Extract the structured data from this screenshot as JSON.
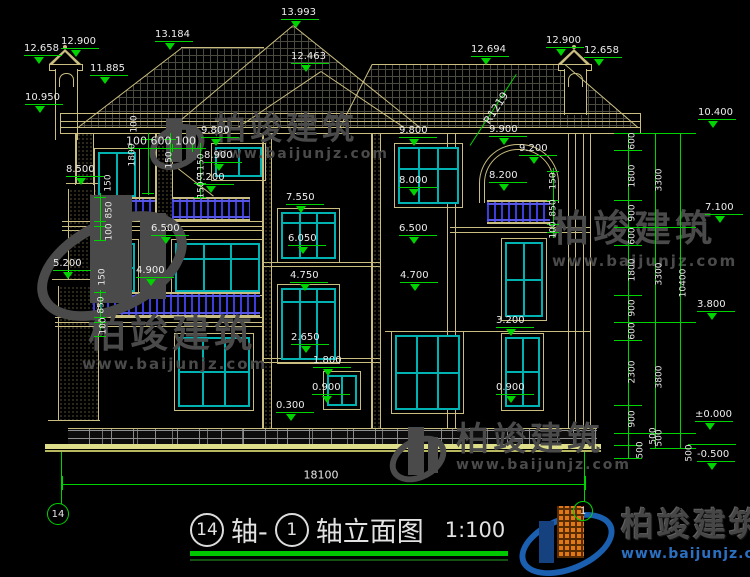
{
  "meta": {
    "drawing_type": "building elevation",
    "sheet_bg": "#000000"
  },
  "colors": {
    "line_tan": "#c9bd7f",
    "dim_green": "#00d400",
    "window_teal": "#00b2b2",
    "railing_blue": "#3c3cdc",
    "text_white": "#ededed",
    "ground_yellow": "#dede8a",
    "stone_gray": "#909090",
    "watermark_gray": "#4a4a4a",
    "logo_blue": "#1a5fb0",
    "logo_orange": "#e07818",
    "url_blue": "#2b6fc0",
    "title_underline_green": "#00c800"
  },
  "title_block": {
    "axis_a": "14",
    "join": "轴-",
    "axis_b": "1",
    "suffix": "轴立面图",
    "scale": "1:100"
  },
  "axis_bubbles": {
    "left": "14",
    "right": "1"
  },
  "brand": {
    "name": "柏竣建筑",
    "url": "www.baijunjz.com"
  },
  "watermarks": [
    {
      "text": "柏竣建筑",
      "url": "www.baijunjz.com"
    },
    {
      "text": "柏竣建筑",
      "url": "www.baijunjz.com"
    },
    {
      "text": "柏竣建筑",
      "url": "www.baijunjz.com"
    },
    {
      "text": "柏竣建筑",
      "url": "www.baijunjz.com"
    }
  ],
  "annotations": {
    "elevation_markers": [
      [
        "13.993",
        281,
        8
      ],
      [
        "13.184",
        155,
        30
      ],
      [
        "12.463",
        291,
        52
      ],
      [
        "12.900",
        61,
        37
      ],
      [
        "12.658",
        24,
        44
      ],
      [
        "11.885",
        90,
        64
      ],
      [
        "10.950",
        25,
        93
      ],
      [
        "12.694",
        471,
        45
      ],
      [
        "12.900",
        546,
        36
      ],
      [
        "12.658",
        584,
        46
      ],
      [
        "9.800",
        201,
        126
      ],
      [
        "9.800",
        399,
        126
      ],
      [
        "9.900",
        489,
        125
      ],
      [
        "9.200",
        519,
        144
      ],
      [
        "8.900",
        204,
        151
      ],
      [
        "8.200",
        196,
        173
      ],
      [
        "8.200",
        489,
        171
      ],
      [
        "8.000",
        399,
        176
      ],
      [
        "8.500",
        66,
        165
      ],
      [
        "7.550",
        286,
        193
      ],
      [
        "6.050",
        288,
        234
      ],
      [
        "6.500",
        151,
        224
      ],
      [
        "6.500",
        399,
        224
      ],
      [
        "5.200",
        53,
        259
      ],
      [
        "4.900",
        136,
        266
      ],
      [
        "4.750",
        290,
        271
      ],
      [
        "4.700",
        400,
        271
      ],
      [
        "3.200",
        496,
        316
      ],
      [
        "2.650",
        291,
        333
      ],
      [
        "1.800",
        313,
        356
      ],
      [
        "0.900",
        312,
        383
      ],
      [
        "0.900",
        496,
        383
      ],
      [
        "0.300",
        276,
        401
      ],
      [
        "10.400",
        698,
        108
      ],
      [
        "7.100",
        705,
        203
      ],
      [
        "3.800",
        697,
        300
      ],
      [
        "±0.000",
        695,
        410
      ],
      [
        "-0.500",
        697,
        450
      ]
    ],
    "rotated_dims": [
      [
        "150",
        109,
        183
      ],
      [
        "850",
        110,
        210
      ],
      [
        "100",
        110,
        232
      ],
      [
        "150",
        103,
        277
      ],
      [
        "850",
        102,
        305
      ],
      [
        "100",
        104,
        326
      ],
      [
        "100",
        135,
        124
      ],
      [
        "1800",
        133,
        155
      ],
      [
        "150",
        170,
        160
      ],
      [
        "1150",
        202,
        165
      ],
      [
        "150",
        202,
        190
      ],
      [
        "150",
        554,
        181
      ],
      [
        "850",
        554,
        208
      ],
      [
        "100",
        554,
        230
      ],
      [
        "600",
        633,
        141
      ],
      [
        "1800",
        633,
        176
      ],
      [
        "900",
        633,
        213
      ],
      [
        "600",
        633,
        236
      ],
      [
        "1800",
        633,
        270
      ],
      [
        "900",
        633,
        308
      ],
      [
        "600",
        633,
        331
      ],
      [
        "2300",
        633,
        372
      ],
      [
        "900",
        633,
        419
      ],
      [
        "500",
        641,
        450
      ],
      [
        "500",
        654,
        436
      ],
      [
        "3300",
        660,
        180
      ],
      [
        "3300",
        660,
        274
      ],
      [
        "3800",
        660,
        377
      ],
      [
        "500",
        660,
        438
      ],
      [
        "10400",
        684,
        283
      ],
      [
        "500",
        690,
        453
      ]
    ],
    "inline_dims": [
      [
        "100 600 100",
        161,
        141,
        0
      ],
      [
        "18100",
        321,
        475,
        0
      ],
      [
        "R1219",
        496,
        108,
        -57
      ]
    ]
  },
  "windows": [
    [
      215,
      147,
      47,
      30,
      2,
      0
    ],
    [
      98,
      152,
      38,
      45,
      2,
      0
    ],
    [
      398,
      147,
      61,
      57,
      3,
      0.37
    ],
    [
      98,
      243,
      37,
      49,
      2,
      0.5
    ],
    [
      175,
      243,
      85,
      49,
      3,
      0.32
    ],
    [
      281,
      212,
      55,
      47,
      3,
      0.22
    ],
    [
      281,
      288,
      55,
      72,
      3,
      0.17
    ],
    [
      327,
      375,
      30,
      31,
      2,
      0
    ],
    [
      505,
      242,
      38,
      75,
      2,
      0.5
    ],
    [
      395,
      335,
      65,
      75,
      3,
      0.5
    ],
    [
      505,
      337,
      35,
      70,
      2,
      0.5
    ],
    [
      178,
      337,
      72,
      70,
      3,
      0.5
    ]
  ],
  "railings": [
    [
      93,
      197,
      62,
      24
    ],
    [
      172,
      197,
      78,
      24
    ],
    [
      93,
      292,
      167,
      25
    ],
    [
      487,
      200,
      63,
      24
    ]
  ],
  "geometry": {
    "tan_h": [
      [
        60,
        113,
        580
      ],
      [
        60,
        121,
        580
      ],
      [
        60,
        127,
        580
      ],
      [
        60,
        133,
        580
      ],
      [
        62,
        221,
        200
      ],
      [
        62,
        226,
        200
      ],
      [
        62,
        230,
        200
      ],
      [
        55,
        317,
        207
      ],
      [
        55,
        322,
        207
      ],
      [
        55,
        326,
        207
      ],
      [
        450,
        227,
        140
      ],
      [
        450,
        232,
        140
      ],
      [
        262,
        262,
        118
      ],
      [
        262,
        266,
        118
      ],
      [
        262,
        358,
        118
      ],
      [
        262,
        362,
        118
      ],
      [
        385,
        331,
        205
      ],
      [
        66,
        183,
        34
      ],
      [
        52,
        279,
        48
      ],
      [
        48,
        420,
        52
      ],
      [
        181,
        47,
        83
      ],
      [
        372,
        64,
        193
      ]
    ],
    "tan_v": [
      [
        75,
        133,
        52
      ],
      [
        93,
        133,
        52
      ],
      [
        262,
        133,
        295
      ],
      [
        271,
        133,
        295
      ],
      [
        371,
        133,
        295
      ],
      [
        380,
        133,
        295
      ],
      [
        447,
        133,
        295
      ],
      [
        455,
        133,
        295
      ],
      [
        568,
        133,
        295
      ],
      [
        575,
        133,
        295
      ],
      [
        583,
        133,
        295
      ],
      [
        590,
        133,
        295
      ],
      [
        60,
        113,
        20
      ],
      [
        640,
        113,
        20
      ],
      [
        155,
        133,
        95
      ],
      [
        172,
        133,
        95
      ]
    ],
    "speckle": [
      [
        76,
        133,
        16,
        50
      ],
      [
        68,
        189,
        29,
        90
      ],
      [
        58,
        286,
        39,
        134
      ],
      [
        156,
        133,
        15,
        92
      ],
      [
        263,
        133,
        7,
        295
      ],
      [
        372,
        133,
        7,
        295
      ]
    ],
    "slopes": [
      [
        172,
        127,
        158,
        -40.1
      ],
      [
        293,
        25,
        163,
        38.8
      ],
      [
        238,
        127,
        100,
        -34
      ],
      [
        321,
        71,
        100,
        34
      ],
      [
        78,
        127,
        130,
        -37.5
      ],
      [
        340,
        127,
        71,
        -63
      ],
      [
        565,
        64,
        97,
        40.8
      ]
    ],
    "green_slopes": [
      [
        470,
        145,
        85,
        -57
      ]
    ],
    "green_v": [
      [
        628,
        133,
        325
      ],
      [
        655,
        133,
        315
      ],
      [
        680,
        133,
        315
      ],
      [
        61,
        452,
        52
      ],
      [
        584,
        452,
        50
      ],
      [
        100,
        193,
        47
      ],
      [
        100,
        290,
        40
      ],
      [
        148,
        133,
        62
      ],
      [
        170,
        133,
        28
      ],
      [
        200,
        143,
        56
      ],
      [
        553,
        168,
        70
      ],
      [
        62,
        476,
        14
      ],
      [
        585,
        476,
        14
      ],
      [
        131,
        144,
        8
      ],
      [
        148,
        144,
        8
      ],
      [
        172,
        144,
        8
      ],
      [
        192,
        144,
        8
      ]
    ],
    "green_h": [
      [
        614,
        133,
        28
      ],
      [
        614,
        150,
        28
      ],
      [
        614,
        200,
        28
      ],
      [
        614,
        227,
        28
      ],
      [
        614,
        245,
        28
      ],
      [
        614,
        295,
        28
      ],
      [
        614,
        322,
        28
      ],
      [
        614,
        340,
        28
      ],
      [
        614,
        405,
        28
      ],
      [
        614,
        433,
        28
      ],
      [
        614,
        445,
        28
      ],
      [
        614,
        458,
        28
      ],
      [
        614,
        133,
        82
      ],
      [
        614,
        227,
        82
      ],
      [
        614,
        322,
        82
      ],
      [
        614,
        433,
        82
      ],
      [
        650,
        448,
        46
      ],
      [
        62,
        484,
        523
      ],
      [
        128,
        148,
        68
      ],
      [
        94,
        197,
        12
      ],
      [
        94,
        221,
        12
      ],
      [
        94,
        226,
        12
      ],
      [
        94,
        240,
        12
      ],
      [
        94,
        292,
        12
      ],
      [
        94,
        317,
        12
      ],
      [
        94,
        322,
        12
      ],
      [
        94,
        336,
        12
      ],
      [
        547,
        171,
        12
      ],
      [
        547,
        200,
        12
      ],
      [
        547,
        224,
        12
      ],
      [
        547,
        232,
        12
      ],
      [
        142,
        139,
        12
      ],
      [
        142,
        193,
        12
      ],
      [
        164,
        139,
        12
      ],
      [
        194,
        148,
        12
      ],
      [
        194,
        183,
        12
      ],
      [
        194,
        197,
        12
      ],
      [
        688,
        444,
        48
      ]
    ]
  }
}
